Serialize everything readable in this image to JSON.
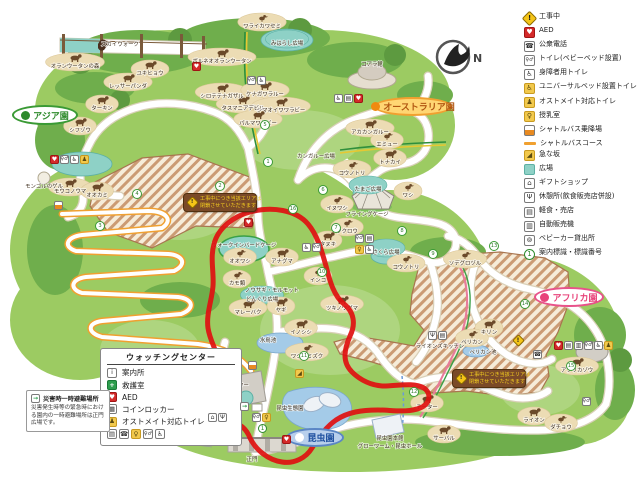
{
  "compass": {
    "label": "N"
  },
  "legend": {
    "items": [
      {
        "icon": "construction",
        "label": "工事中"
      },
      {
        "icon": "aed",
        "label": "AED"
      },
      {
        "icon": "phone",
        "label": "公衆電話"
      },
      {
        "icon": "toilet",
        "label": "トイレ(ベビーベッド設置)"
      },
      {
        "icon": "wheelchair",
        "label": "身障者用トイレ"
      },
      {
        "icon": "ubed",
        "label": "ユニバーサルベッド設置トイレ"
      },
      {
        "icon": "ostomate",
        "label": "オストメイト対応トイレ"
      },
      {
        "icon": "nursing",
        "label": "授乳室"
      },
      {
        "icon": "bus",
        "label": "シャトルバス乗降場"
      },
      {
        "icon": "busline",
        "label": "シャトルバスコース"
      },
      {
        "icon": "slope",
        "label": "急な坂"
      },
      {
        "icon": "plaza",
        "label": "広場"
      },
      {
        "icon": "gift",
        "label": "ギフトショップ"
      },
      {
        "icon": "rest",
        "label": "休憩所(飲食販売店併設)"
      },
      {
        "icon": "snack",
        "label": "軽食・売店"
      },
      {
        "icon": "vending",
        "label": "自動販売機"
      },
      {
        "icon": "stroller",
        "label": "ベビーカー貸出所"
      },
      {
        "icon": "signnum",
        "label": "案内標識・標識番号"
      }
    ]
  },
  "watching_center": {
    "title": "ウォッチングセンター",
    "items": [
      {
        "icon": "info",
        "label": "案内所"
      },
      {
        "icon": "aid",
        "label": "救護室"
      },
      {
        "icon": "aed",
        "label": "AED"
      },
      {
        "icon": "locker",
        "label": "コインロッカー"
      },
      {
        "icon": "ostomate",
        "label": "オストメイト対応トイレ"
      }
    ],
    "icon_row": [
      "snack",
      "phone",
      "nursing",
      "toilet",
      "wheelchair"
    ]
  },
  "disaster": {
    "title": "災害時一時避難場所",
    "body": "災害発生時等の緊急時における園内の一時避難場所は正門広場です。"
  },
  "construction_sign": {
    "line1": "工事中につき当該エリアは",
    "line2": "閉鎖させていただきます"
  },
  "signs": [
    {
      "x": 183,
      "y": 193,
      "w": 74
    },
    {
      "x": 452,
      "y": 369,
      "w": 74
    }
  ],
  "areas": [
    {
      "label": "アジア園",
      "style": "green",
      "dot": "#2e8a2c",
      "x": 12,
      "y": 105,
      "w": 66,
      "h": 20
    },
    {
      "label": "オーストラリア園",
      "style": "orange",
      "dot": "#f08a10",
      "x": 374,
      "y": 97,
      "w": 78,
      "h": 19
    },
    {
      "label": "アフリカ園",
      "style": "pink",
      "dot": "#e8437a",
      "x": 534,
      "y": 287,
      "w": 70,
      "h": 20
    },
    {
      "label": "昆虫園",
      "style": "blue",
      "dot": "#ffffff",
      "x": 286,
      "y": 428,
      "w": 58,
      "h": 19
    }
  ],
  "map_labels": [
    {
      "x": 75,
      "y": 68,
      "l": "オランウータンの森",
      "k": "q"
    },
    {
      "x": 120,
      "y": 46,
      "l": "スカイウォーク",
      "k": "t"
    },
    {
      "x": 150,
      "y": 75,
      "l": "ユキヒョウ",
      "k": "q"
    },
    {
      "x": 128,
      "y": 88,
      "l": "レッサーパンダ",
      "k": "q"
    },
    {
      "x": 102,
      "y": 110,
      "l": "ターキン",
      "k": "q"
    },
    {
      "x": 80,
      "y": 132,
      "l": "シフゾウ",
      "k": "q"
    },
    {
      "x": 222,
      "y": 63,
      "l": "ボルネオオランウータン",
      "k": "q"
    },
    {
      "x": 222,
      "y": 98,
      "l": "シロテテナガザル",
      "k": "q"
    },
    {
      "x": 262,
      "y": 28,
      "l": "ワライカワセミ",
      "k": "b"
    },
    {
      "x": 287,
      "y": 45,
      "l": "みはらし広場",
      "k": "p"
    },
    {
      "x": 70,
      "y": 193,
      "l": "モウコノウマ",
      "k": "q"
    },
    {
      "x": 44,
      "y": 188,
      "l": "モンゴルのゲル",
      "k": "t"
    },
    {
      "x": 97,
      "y": 197,
      "l": "オオカミ",
      "k": "q"
    },
    {
      "x": 265,
      "y": 96,
      "l": "ケナガワラルー",
      "k": "q"
    },
    {
      "x": 243,
      "y": 110,
      "l": "タスマニアデビル",
      "k": "q"
    },
    {
      "x": 281,
      "y": 112,
      "l": "シマオイワワラビー",
      "k": "q"
    },
    {
      "x": 258,
      "y": 125,
      "l": "パルマワラビー",
      "k": "q"
    },
    {
      "x": 372,
      "y": 66,
      "l": "コアラ館",
      "k": "t"
    },
    {
      "x": 370,
      "y": 134,
      "l": "アカカンガルー",
      "k": "q"
    },
    {
      "x": 387,
      "y": 146,
      "l": "エミュー",
      "k": "b"
    },
    {
      "x": 316,
      "y": 158,
      "l": "カンガルー広場",
      "k": "t"
    },
    {
      "x": 390,
      "y": 164,
      "l": "トナカイ",
      "k": "q"
    },
    {
      "x": 352,
      "y": 175,
      "l": "コウノトリ",
      "k": "b"
    },
    {
      "x": 368,
      "y": 191,
      "l": "たまご広場",
      "k": "p"
    },
    {
      "x": 337,
      "y": 210,
      "l": "イヌワシ",
      "k": "b"
    },
    {
      "x": 408,
      "y": 197,
      "l": "ワシ",
      "k": "b"
    },
    {
      "x": 367,
      "y": 216,
      "l": "フライングケージ",
      "k": "t"
    },
    {
      "x": 347,
      "y": 233,
      "l": "フクロウ",
      "k": "b"
    },
    {
      "x": 328,
      "y": 246,
      "l": "タヌキ",
      "k": "q"
    },
    {
      "x": 386,
      "y": 254,
      "l": "さくら広場",
      "k": "p"
    },
    {
      "x": 406,
      "y": 269,
      "l": "コウノトリ",
      "k": "b"
    },
    {
      "x": 465,
      "y": 265,
      "l": "ソデグロヅル",
      "k": "b"
    },
    {
      "x": 244,
      "y": 247,
      "l": "ウォークインバードケージ",
      "k": "t"
    },
    {
      "x": 237,
      "y": 285,
      "l": "カモ類",
      "k": "b"
    },
    {
      "x": 240,
      "y": 263,
      "l": "オオワシ",
      "k": "b"
    },
    {
      "x": 282,
      "y": 263,
      "l": "アナグマ",
      "k": "q"
    },
    {
      "x": 272,
      "y": 292,
      "l": "ノウサギ・モルモット",
      "k": "t"
    },
    {
      "x": 262,
      "y": 301,
      "l": "どんぐり広場",
      "k": "p"
    },
    {
      "x": 248,
      "y": 314,
      "l": "マレーバク",
      "k": "q"
    },
    {
      "x": 281,
      "y": 312,
      "l": "ヤギ",
      "k": "q"
    },
    {
      "x": 342,
      "y": 310,
      "l": "ツキノワグマ",
      "k": "q"
    },
    {
      "x": 318,
      "y": 282,
      "l": "インコ",
      "k": "b"
    },
    {
      "x": 301,
      "y": 334,
      "l": "イノシシ",
      "k": "q"
    },
    {
      "x": 268,
      "y": 342,
      "l": "水鳥池",
      "k": "t"
    },
    {
      "x": 307,
      "y": 358,
      "l": "ワシミミズク",
      "k": "b"
    },
    {
      "x": 489,
      "y": 334,
      "l": "キリン",
      "k": "q"
    },
    {
      "x": 472,
      "y": 344,
      "l": "ペリカン",
      "k": "b"
    },
    {
      "x": 483,
      "y": 354,
      "l": "ペリカン池",
      "k": "t"
    },
    {
      "x": 577,
      "y": 372,
      "l": "アフリカゾウ",
      "k": "q"
    },
    {
      "x": 427,
      "y": 409,
      "l": "チーター",
      "k": "q"
    },
    {
      "x": 444,
      "y": 440,
      "l": "サーバル",
      "k": "q"
    },
    {
      "x": 534,
      "y": 422,
      "l": "ライオン",
      "k": "q"
    },
    {
      "x": 561,
      "y": 429,
      "l": "ダチョウ",
      "k": "b"
    },
    {
      "x": 440,
      "y": 348,
      "l": "ライオンズキッチン",
      "k": "t"
    },
    {
      "x": 290,
      "y": 410,
      "l": "昆虫生態園",
      "k": "t"
    },
    {
      "x": 390,
      "y": 440,
      "l": "昆虫園本館",
      "k": "t"
    },
    {
      "x": 390,
      "y": 448,
      "l": "グローワーム・昆虫ホール",
      "k": "t"
    },
    {
      "x": 252,
      "y": 461,
      "l": "正門",
      "k": "t"
    },
    {
      "x": 196,
      "y": 435,
      "l": "ギフトショップ",
      "k": "t"
    },
    {
      "x": 222,
      "y": 387,
      "l": "ウォッチングセンター",
      "k": "t"
    }
  ],
  "icon_clusters": [
    {
      "x": 50,
      "y": 155,
      "icons": [
        "aed",
        "toilet",
        "wheelchair",
        "ostomate"
      ]
    },
    {
      "x": 54,
      "y": 201,
      "icons": [
        "bus"
      ]
    },
    {
      "x": 192,
      "y": 62,
      "icons": [
        "aed"
      ]
    },
    {
      "x": 247,
      "y": 76,
      "icons": [
        "toilet",
        "wheelchair"
      ]
    },
    {
      "x": 334,
      "y": 94,
      "icons": [
        "wheelchair",
        "snack",
        "aed"
      ]
    },
    {
      "x": 355,
      "y": 234,
      "icons": [
        "toilet",
        "snack"
      ]
    },
    {
      "x": 355,
      "y": 245,
      "icons": [
        "nursing",
        "wheelchair"
      ]
    },
    {
      "x": 302,
      "y": 243,
      "icons": [
        "wheelchair",
        "toilet"
      ]
    },
    {
      "x": 244,
      "y": 218,
      "icons": [
        "aed"
      ]
    },
    {
      "x": 248,
      "y": 361,
      "icons": [
        "bus"
      ]
    },
    {
      "x": 208,
      "y": 413,
      "icons": [
        "gift",
        "rest"
      ]
    },
    {
      "x": 240,
      "y": 402,
      "icons": [
        "evac"
      ]
    },
    {
      "x": 252,
      "y": 413,
      "icons": [
        "toilet",
        "nursing"
      ]
    },
    {
      "x": 258,
      "y": 424,
      "icons": [
        "signnum"
      ]
    },
    {
      "x": 282,
      "y": 435,
      "icons": [
        "aed"
      ]
    },
    {
      "x": 428,
      "y": 331,
      "icons": [
        "rest",
        "snack"
      ]
    },
    {
      "x": 554,
      "y": 341,
      "icons": [
        "aed",
        "snack",
        "vending",
        "toilet",
        "wheelchair",
        "ostomate"
      ]
    },
    {
      "x": 514,
      "y": 336,
      "icons": [
        "construction"
      ]
    },
    {
      "x": 533,
      "y": 350,
      "icons": [
        "phone"
      ]
    },
    {
      "x": 582,
      "y": 397,
      "icons": [
        "toilet"
      ]
    },
    {
      "x": 295,
      "y": 369,
      "icons": [
        "slope"
      ]
    }
  ],
  "number_markers": [
    {
      "n": "1",
      "x": 263,
      "y": 157
    },
    {
      "n": "2",
      "x": 215,
      "y": 181
    },
    {
      "n": "3",
      "x": 95,
      "y": 221
    },
    {
      "n": "4",
      "x": 132,
      "y": 189
    },
    {
      "n": "5",
      "x": 260,
      "y": 120
    },
    {
      "n": "6",
      "x": 318,
      "y": 185
    },
    {
      "n": "7",
      "x": 331,
      "y": 223
    },
    {
      "n": "8",
      "x": 397,
      "y": 226
    },
    {
      "n": "9",
      "x": 428,
      "y": 249
    },
    {
      "n": "10",
      "x": 317,
      "y": 267
    },
    {
      "n": "11",
      "x": 299,
      "y": 351
    },
    {
      "n": "12",
      "x": 409,
      "y": 387
    },
    {
      "n": "13",
      "x": 489,
      "y": 241
    },
    {
      "n": "14",
      "x": 520,
      "y": 299
    },
    {
      "n": "15",
      "x": 566,
      "y": 361
    },
    {
      "n": "16",
      "x": 288,
      "y": 204
    }
  ],
  "colors": {
    "map_green": "#9ccb62",
    "tree_green": "#6fae4c",
    "path_white": "#ffffff",
    "enclosure": "#ecdcb4",
    "plaza_teal": "#8ed1c6",
    "water": "#a4cbe8",
    "shuttle_orange": "#f0a030",
    "annotation_red": "#e01010",
    "hatch_brown": "#cb9b74"
  }
}
